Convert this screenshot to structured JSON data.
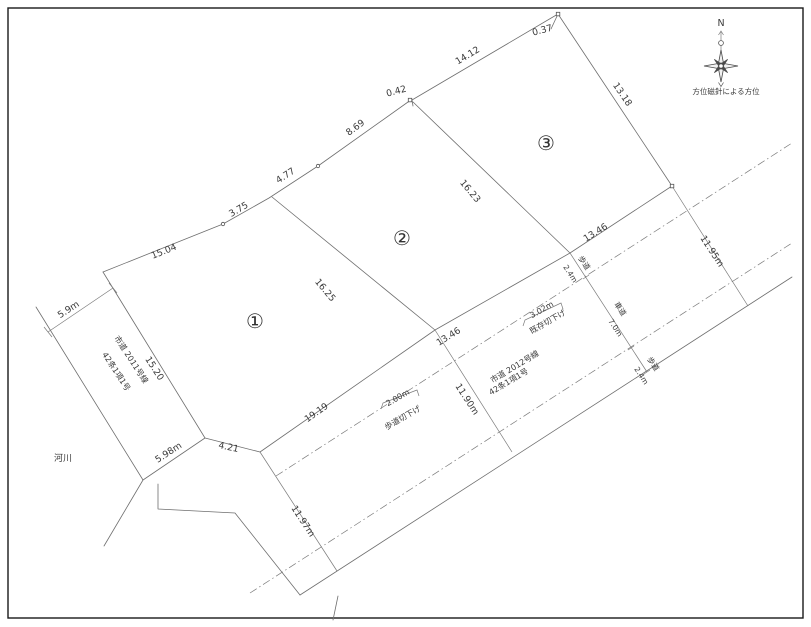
{
  "compass": {
    "north": "N",
    "caption": "方位磁針による方位"
  },
  "plots": [
    {
      "number": "①"
    },
    {
      "number": "②"
    },
    {
      "number": "③"
    }
  ],
  "boundary": {
    "seg_15_04": "15.04",
    "seg_3_75": "3.75",
    "seg_4_77": "4.77",
    "seg_8_69": "8.69",
    "offset_0_42": "0.42",
    "seg_14_12": "14.12",
    "offset_0_37": "0.37",
    "seg_13_18": "13.18"
  },
  "dividers": {
    "plot1_2": "16.25",
    "plot2_3": "16.23"
  },
  "frontage": {
    "seg1": "19.19",
    "seg2": "13.46",
    "seg3": "13.46"
  },
  "road_2012": {
    "name": "市道 2012号線",
    "article": "42条1項1号",
    "width_left": "11.97m",
    "width_mid": "11.90m",
    "width_right": "11.95m",
    "sidewalk_label": "歩道",
    "roadway_label": "車道",
    "sidewalk_top": "2.4m",
    "roadway_width": "7.0m",
    "sidewalk_bottom": "2.4m",
    "curb_cut_new_dim": "2.00m",
    "curb_cut_new": "歩道切下げ",
    "curb_cut_exist_dim": "3.02m",
    "curb_cut_exist": "既存切下げ"
  },
  "road_2011": {
    "name": "市道 2011号線",
    "article": "42条1項1号",
    "width": "5.9m",
    "length": "15.20",
    "end_width": "5.98m",
    "corner_cut": "4.21"
  },
  "river": {
    "label": "河川"
  }
}
